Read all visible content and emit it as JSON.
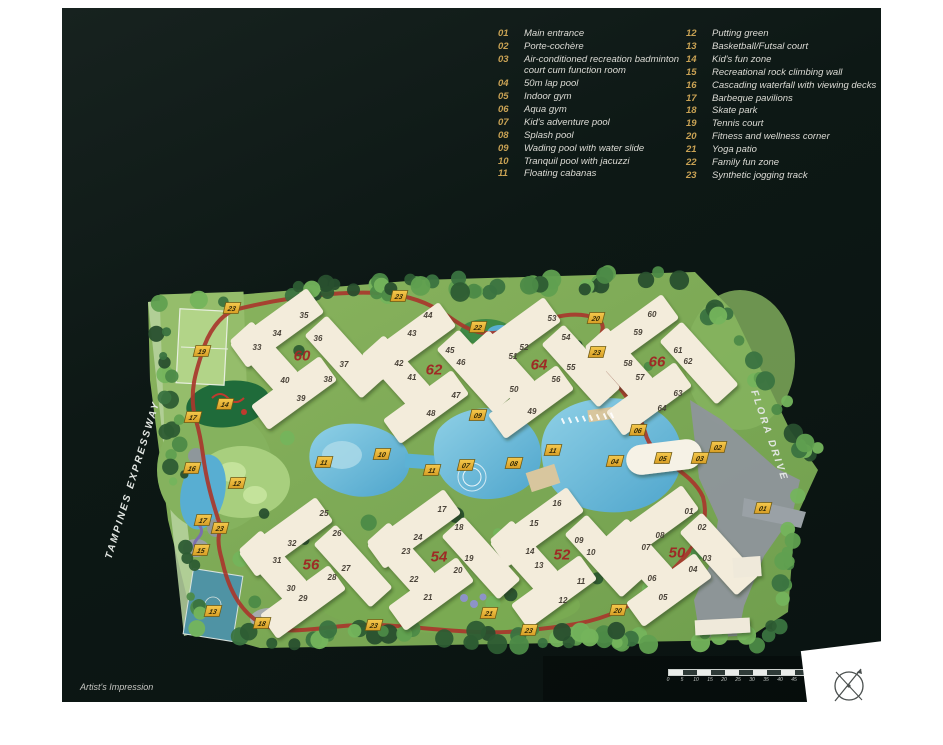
{
  "panel": {
    "artist_note": "Artist's Impression"
  },
  "legend": {
    "left": [
      {
        "num": "01",
        "label": "Main entrance"
      },
      {
        "num": "02",
        "label": "Porte-cochère"
      },
      {
        "num": "03",
        "label": "Air-conditioned recreation badminton court cum function room"
      },
      {
        "num": "04",
        "label": "50m lap pool"
      },
      {
        "num": "05",
        "label": "Indoor gym"
      },
      {
        "num": "06",
        "label": "Aqua gym"
      },
      {
        "num": "07",
        "label": "Kid's adventure pool"
      },
      {
        "num": "08",
        "label": "Splash pool"
      },
      {
        "num": "09",
        "label": "Wading pool with water slide"
      },
      {
        "num": "10",
        "label": "Tranquil pool with jacuzzi"
      },
      {
        "num": "11",
        "label": "Floating cabanas"
      }
    ],
    "right": [
      {
        "num": "12",
        "label": "Putting green"
      },
      {
        "num": "13",
        "label": "Basketball/Futsal court"
      },
      {
        "num": "14",
        "label": "Kid's fun zone"
      },
      {
        "num": "15",
        "label": "Recreational rock climbing wall"
      },
      {
        "num": "16",
        "label": "Cascading waterfall with viewing decks"
      },
      {
        "num": "17",
        "label": "Barbeque pavilions"
      },
      {
        "num": "18",
        "label": "Skate park"
      },
      {
        "num": "19",
        "label": "Tennis court"
      },
      {
        "num": "20",
        "label": "Fitness and wellness corner"
      },
      {
        "num": "21",
        "label": "Yoga patio"
      },
      {
        "num": "22",
        "label": "Family fun zone"
      },
      {
        "num": "23",
        "label": "Synthetic jogging track"
      }
    ]
  },
  "roads": {
    "west": "TAMPINES EXPRESSWAY",
    "east": "FLORA DRIVE"
  },
  "scale_bar": {
    "ticks": [
      "0",
      "5",
      "10",
      "15",
      "20",
      "25",
      "30",
      "35",
      "40",
      "45",
      "50"
    ]
  },
  "map": {
    "colors": {
      "marker_bg": "#ecb83b",
      "block_number": "#9e2b26",
      "jogging_track": "#a8372c",
      "water": "#58b0d6",
      "building": "#f3ecdb",
      "grass": "#7cab55"
    },
    "blocks": [
      {
        "label": "60",
        "x": 302,
        "y": 355,
        "units": [
          {
            "n": "33",
            "x": 257,
            "y": 347
          },
          {
            "n": "34",
            "x": 277,
            "y": 333
          },
          {
            "n": "35",
            "x": 304,
            "y": 315
          },
          {
            "n": "36",
            "x": 318,
            "y": 338
          },
          {
            "n": "37",
            "x": 344,
            "y": 364
          },
          {
            "n": "38",
            "x": 328,
            "y": 379
          },
          {
            "n": "39",
            "x": 301,
            "y": 398
          },
          {
            "n": "40",
            "x": 285,
            "y": 380
          }
        ]
      },
      {
        "label": "62",
        "x": 434,
        "y": 369,
        "units": [
          {
            "n": "41",
            "x": 412,
            "y": 377
          },
          {
            "n": "42",
            "x": 399,
            "y": 363
          },
          {
            "n": "43",
            "x": 412,
            "y": 333
          },
          {
            "n": "44",
            "x": 428,
            "y": 315
          },
          {
            "n": "45",
            "x": 450,
            "y": 350
          },
          {
            "n": "46",
            "x": 461,
            "y": 362
          },
          {
            "n": "47",
            "x": 456,
            "y": 395
          },
          {
            "n": "48",
            "x": 431,
            "y": 413
          }
        ]
      },
      {
        "label": "64",
        "x": 539,
        "y": 364,
        "units": [
          {
            "n": "49",
            "x": 532,
            "y": 411
          },
          {
            "n": "50",
            "x": 514,
            "y": 389
          },
          {
            "n": "51",
            "x": 513,
            "y": 356
          },
          {
            "n": "52",
            "x": 524,
            "y": 347
          },
          {
            "n": "53",
            "x": 552,
            "y": 318
          },
          {
            "n": "54",
            "x": 566,
            "y": 337
          },
          {
            "n": "55",
            "x": 571,
            "y": 367
          },
          {
            "n": "56",
            "x": 556,
            "y": 379
          }
        ]
      },
      {
        "label": "66",
        "x": 657,
        "y": 361,
        "units": [
          {
            "n": "57",
            "x": 640,
            "y": 377
          },
          {
            "n": "58",
            "x": 628,
            "y": 363
          },
          {
            "n": "59",
            "x": 638,
            "y": 332
          },
          {
            "n": "60",
            "x": 652,
            "y": 314
          },
          {
            "n": "61",
            "x": 678,
            "y": 350
          },
          {
            "n": "62",
            "x": 688,
            "y": 361
          },
          {
            "n": "63",
            "x": 678,
            "y": 393
          },
          {
            "n": "64",
            "x": 662,
            "y": 408
          }
        ]
      },
      {
        "label": "56",
        "x": 311,
        "y": 564,
        "units": [
          {
            "n": "25",
            "x": 324,
            "y": 513
          },
          {
            "n": "26",
            "x": 337,
            "y": 533
          },
          {
            "n": "27",
            "x": 346,
            "y": 568
          },
          {
            "n": "28",
            "x": 332,
            "y": 577
          },
          {
            "n": "29",
            "x": 303,
            "y": 598
          },
          {
            "n": "30",
            "x": 291,
            "y": 588
          },
          {
            "n": "31",
            "x": 277,
            "y": 560
          },
          {
            "n": "32",
            "x": 292,
            "y": 543
          }
        ]
      },
      {
        "label": "54",
        "x": 439,
        "y": 556,
        "units": [
          {
            "n": "17",
            "x": 442,
            "y": 509
          },
          {
            "n": "18",
            "x": 459,
            "y": 527
          },
          {
            "n": "19",
            "x": 469,
            "y": 558
          },
          {
            "n": "20",
            "x": 458,
            "y": 570
          },
          {
            "n": "21",
            "x": 428,
            "y": 597
          },
          {
            "n": "22",
            "x": 414,
            "y": 579
          },
          {
            "n": "23",
            "x": 406,
            "y": 551
          },
          {
            "n": "24",
            "x": 418,
            "y": 537
          }
        ]
      },
      {
        "label": "52",
        "x": 562,
        "y": 554,
        "units": [
          {
            "n": "09",
            "x": 579,
            "y": 540
          },
          {
            "n": "10",
            "x": 591,
            "y": 552
          },
          {
            "n": "11",
            "x": 581,
            "y": 581
          },
          {
            "n": "12",
            "x": 563,
            "y": 600
          },
          {
            "n": "13",
            "x": 539,
            "y": 565
          },
          {
            "n": "14",
            "x": 530,
            "y": 551
          },
          {
            "n": "15",
            "x": 534,
            "y": 523
          },
          {
            "n": "16",
            "x": 557,
            "y": 503
          }
        ]
      },
      {
        "label": "50",
        "x": 677,
        "y": 552,
        "units": [
          {
            "n": "01",
            "x": 689,
            "y": 511
          },
          {
            "n": "02",
            "x": 702,
            "y": 527
          },
          {
            "n": "03",
            "x": 707,
            "y": 558
          },
          {
            "n": "04",
            "x": 693,
            "y": 569
          },
          {
            "n": "05",
            "x": 663,
            "y": 597
          },
          {
            "n": "06",
            "x": 652,
            "y": 578
          },
          {
            "n": "07",
            "x": 646,
            "y": 547
          },
          {
            "n": "08",
            "x": 660,
            "y": 535
          }
        ]
      }
    ],
    "markers": [
      {
        "n": "01",
        "x": 763,
        "y": 508
      },
      {
        "n": "02",
        "x": 718,
        "y": 447
      },
      {
        "n": "03",
        "x": 700,
        "y": 458
      },
      {
        "n": "04",
        "x": 615,
        "y": 461
      },
      {
        "n": "05",
        "x": 663,
        "y": 458
      },
      {
        "n": "06",
        "x": 638,
        "y": 430
      },
      {
        "n": "07",
        "x": 466,
        "y": 465
      },
      {
        "n": "08",
        "x": 514,
        "y": 463
      },
      {
        "n": "09",
        "x": 478,
        "y": 415
      },
      {
        "n": "10",
        "x": 382,
        "y": 454
      },
      {
        "n": "11",
        "x": 324,
        "y": 462
      },
      {
        "n": "11",
        "x": 432,
        "y": 470
      },
      {
        "n": "11",
        "x": 553,
        "y": 450
      },
      {
        "n": "12",
        "x": 237,
        "y": 483
      },
      {
        "n": "13",
        "x": 213,
        "y": 611
      },
      {
        "n": "14",
        "x": 225,
        "y": 404
      },
      {
        "n": "15",
        "x": 201,
        "y": 550
      },
      {
        "n": "16",
        "x": 192,
        "y": 468
      },
      {
        "n": "17",
        "x": 193,
        "y": 417
      },
      {
        "n": "17",
        "x": 203,
        "y": 520
      },
      {
        "n": "18",
        "x": 262,
        "y": 623
      },
      {
        "n": "19",
        "x": 202,
        "y": 351
      },
      {
        "n": "20",
        "x": 596,
        "y": 318
      },
      {
        "n": "20",
        "x": 618,
        "y": 610
      },
      {
        "n": "21",
        "x": 489,
        "y": 613
      },
      {
        "n": "22",
        "x": 478,
        "y": 327
      },
      {
        "n": "23",
        "x": 232,
        "y": 308
      },
      {
        "n": "23",
        "x": 399,
        "y": 296
      },
      {
        "n": "23",
        "x": 597,
        "y": 352
      },
      {
        "n": "23",
        "x": 220,
        "y": 528
      },
      {
        "n": "23",
        "x": 374,
        "y": 625
      },
      {
        "n": "23",
        "x": 529,
        "y": 630
      }
    ]
  }
}
